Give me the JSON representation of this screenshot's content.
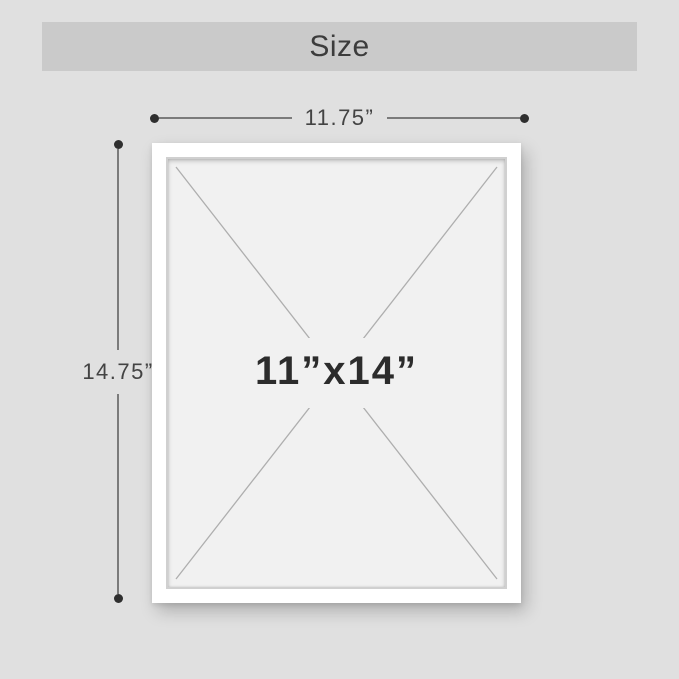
{
  "title_bar": {
    "label": "Size"
  },
  "dimension_width": {
    "label": "11.75”"
  },
  "dimension_height": {
    "label": "14.75”"
  },
  "frame": {
    "size_label": "11”x14”"
  },
  "colors": {
    "page_bg": "#e0e0e0",
    "banner_bg": "#cacaca",
    "banner_text": "#3c3c3c",
    "dimension_line": "#7b7b7b",
    "dimension_dot": "#2f2f2f",
    "dimension_text": "#434343",
    "frame_white": "#ffffff",
    "mat_bg": "#f1f1f1",
    "diagonal_line": "#aeaeae",
    "size_text": "#2c2c2c"
  }
}
